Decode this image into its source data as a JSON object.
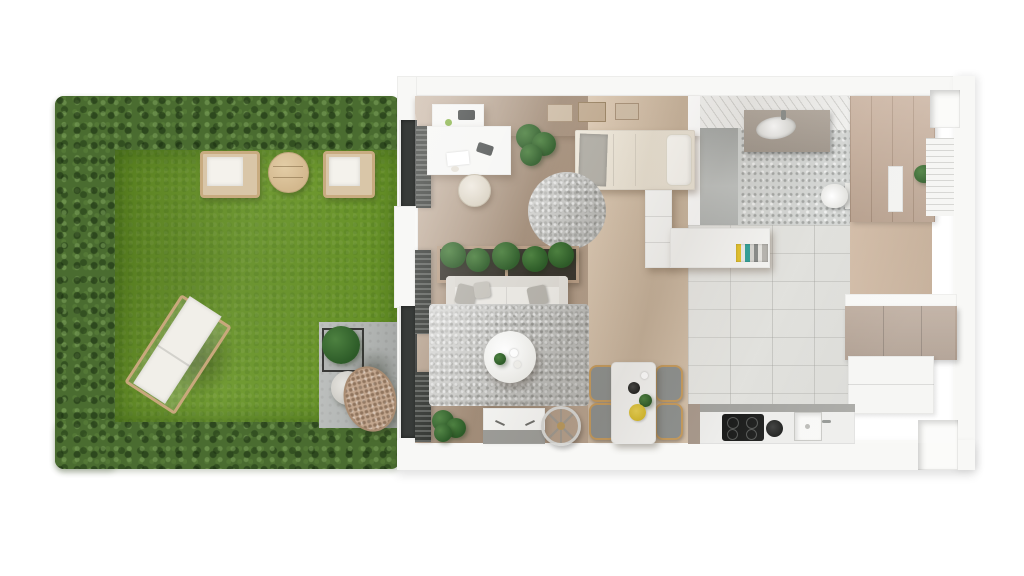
{
  "scene": {
    "type": "3d-floor-plan-top-view",
    "description": "Top-down 3D render of a studio apartment with a hedged garden terrace",
    "rooms": {
      "garden": "Garden with hedge border and lawn",
      "patio": "Concrete patio with hanging chair",
      "living": "Living and sleeping area",
      "dining": "Dining corner",
      "kitchen": "Kitchen",
      "bathroom": "Bathroom with shower",
      "hallway": "Hallway with wardrobes"
    },
    "objects": {
      "hedge": "Trimmed hedge border",
      "grass": "Lawn",
      "armchair_left": "Garden armchair",
      "armchair_right": "Garden armchair",
      "garden_table": "Round wooden garden table",
      "sun_lounger": "Sun lounger",
      "patio_plant": "Potted shrub in stand",
      "egg_chair": "Hanging rattan egg chair",
      "window_door": "Floor-to-ceiling window",
      "desk": "Desk with chair",
      "desk_chair": "Desk chair",
      "wall_shelf": "Wall shelf",
      "pictures": "Framed pictures on wall",
      "bed": "Single bed with pillow",
      "dresser": "White dresser",
      "bookshelf": "Half wall shelf with books",
      "round_rug": "Round shaggy rug",
      "planter_row": "Indoor planter boxes",
      "sofa": "White sofa with cushions",
      "area_rug": "Shaggy area rug",
      "coffee_table": "Round coffee table",
      "tv_bench": "TV bench",
      "indoor_plant": "Indoor plant",
      "bicycle_wheel": "Bicycle wheel",
      "dining_table": "Dining table",
      "dining_chair": "Dining chair",
      "plate": "Yellow plate with herbs",
      "kettle": "Black kettle",
      "cooktop": "Induction cooktop",
      "kitchen_sink": "Kitchen sink",
      "pot": "Black pot",
      "kitchen_counter": "Kitchen counter",
      "upper_cabinets": "Taupe upper cabinets",
      "lower_cabinets": "White lower cabinets",
      "shower": "Walk-in shower",
      "vanity": "Bathroom vanity with sink",
      "toilet": "Wall-hung toilet",
      "wardrobe": "Built-in wardrobes",
      "hall_plant": "Plant on shelf",
      "window_niche": "Window niche"
    },
    "palette": {
      "hedge_green": "#4a6c30",
      "grass_green": "#689525",
      "patio_concrete": "#b2b5b3",
      "wood_floor": "#b49e8a",
      "wood_floor_light": "#d2bfa9",
      "kitchen_tile": "#e2e2de",
      "terrazzo": "#d5d7d5",
      "wall_white": "#f8f8f6",
      "wall_face_beige": "#d3c7b7",
      "cabinet_taupe": "#b2a193",
      "wardrobe_wood": "#c6ad99",
      "rug_gray": "#c6c6c3",
      "window_frame_dark": "#383b39",
      "rattan": "#c3a78f",
      "book_yellow": "#e6c52f",
      "book_teal": "#35a39b",
      "plate_yellow": "#ddc133",
      "chair_gold": "#c59b5e"
    }
  }
}
